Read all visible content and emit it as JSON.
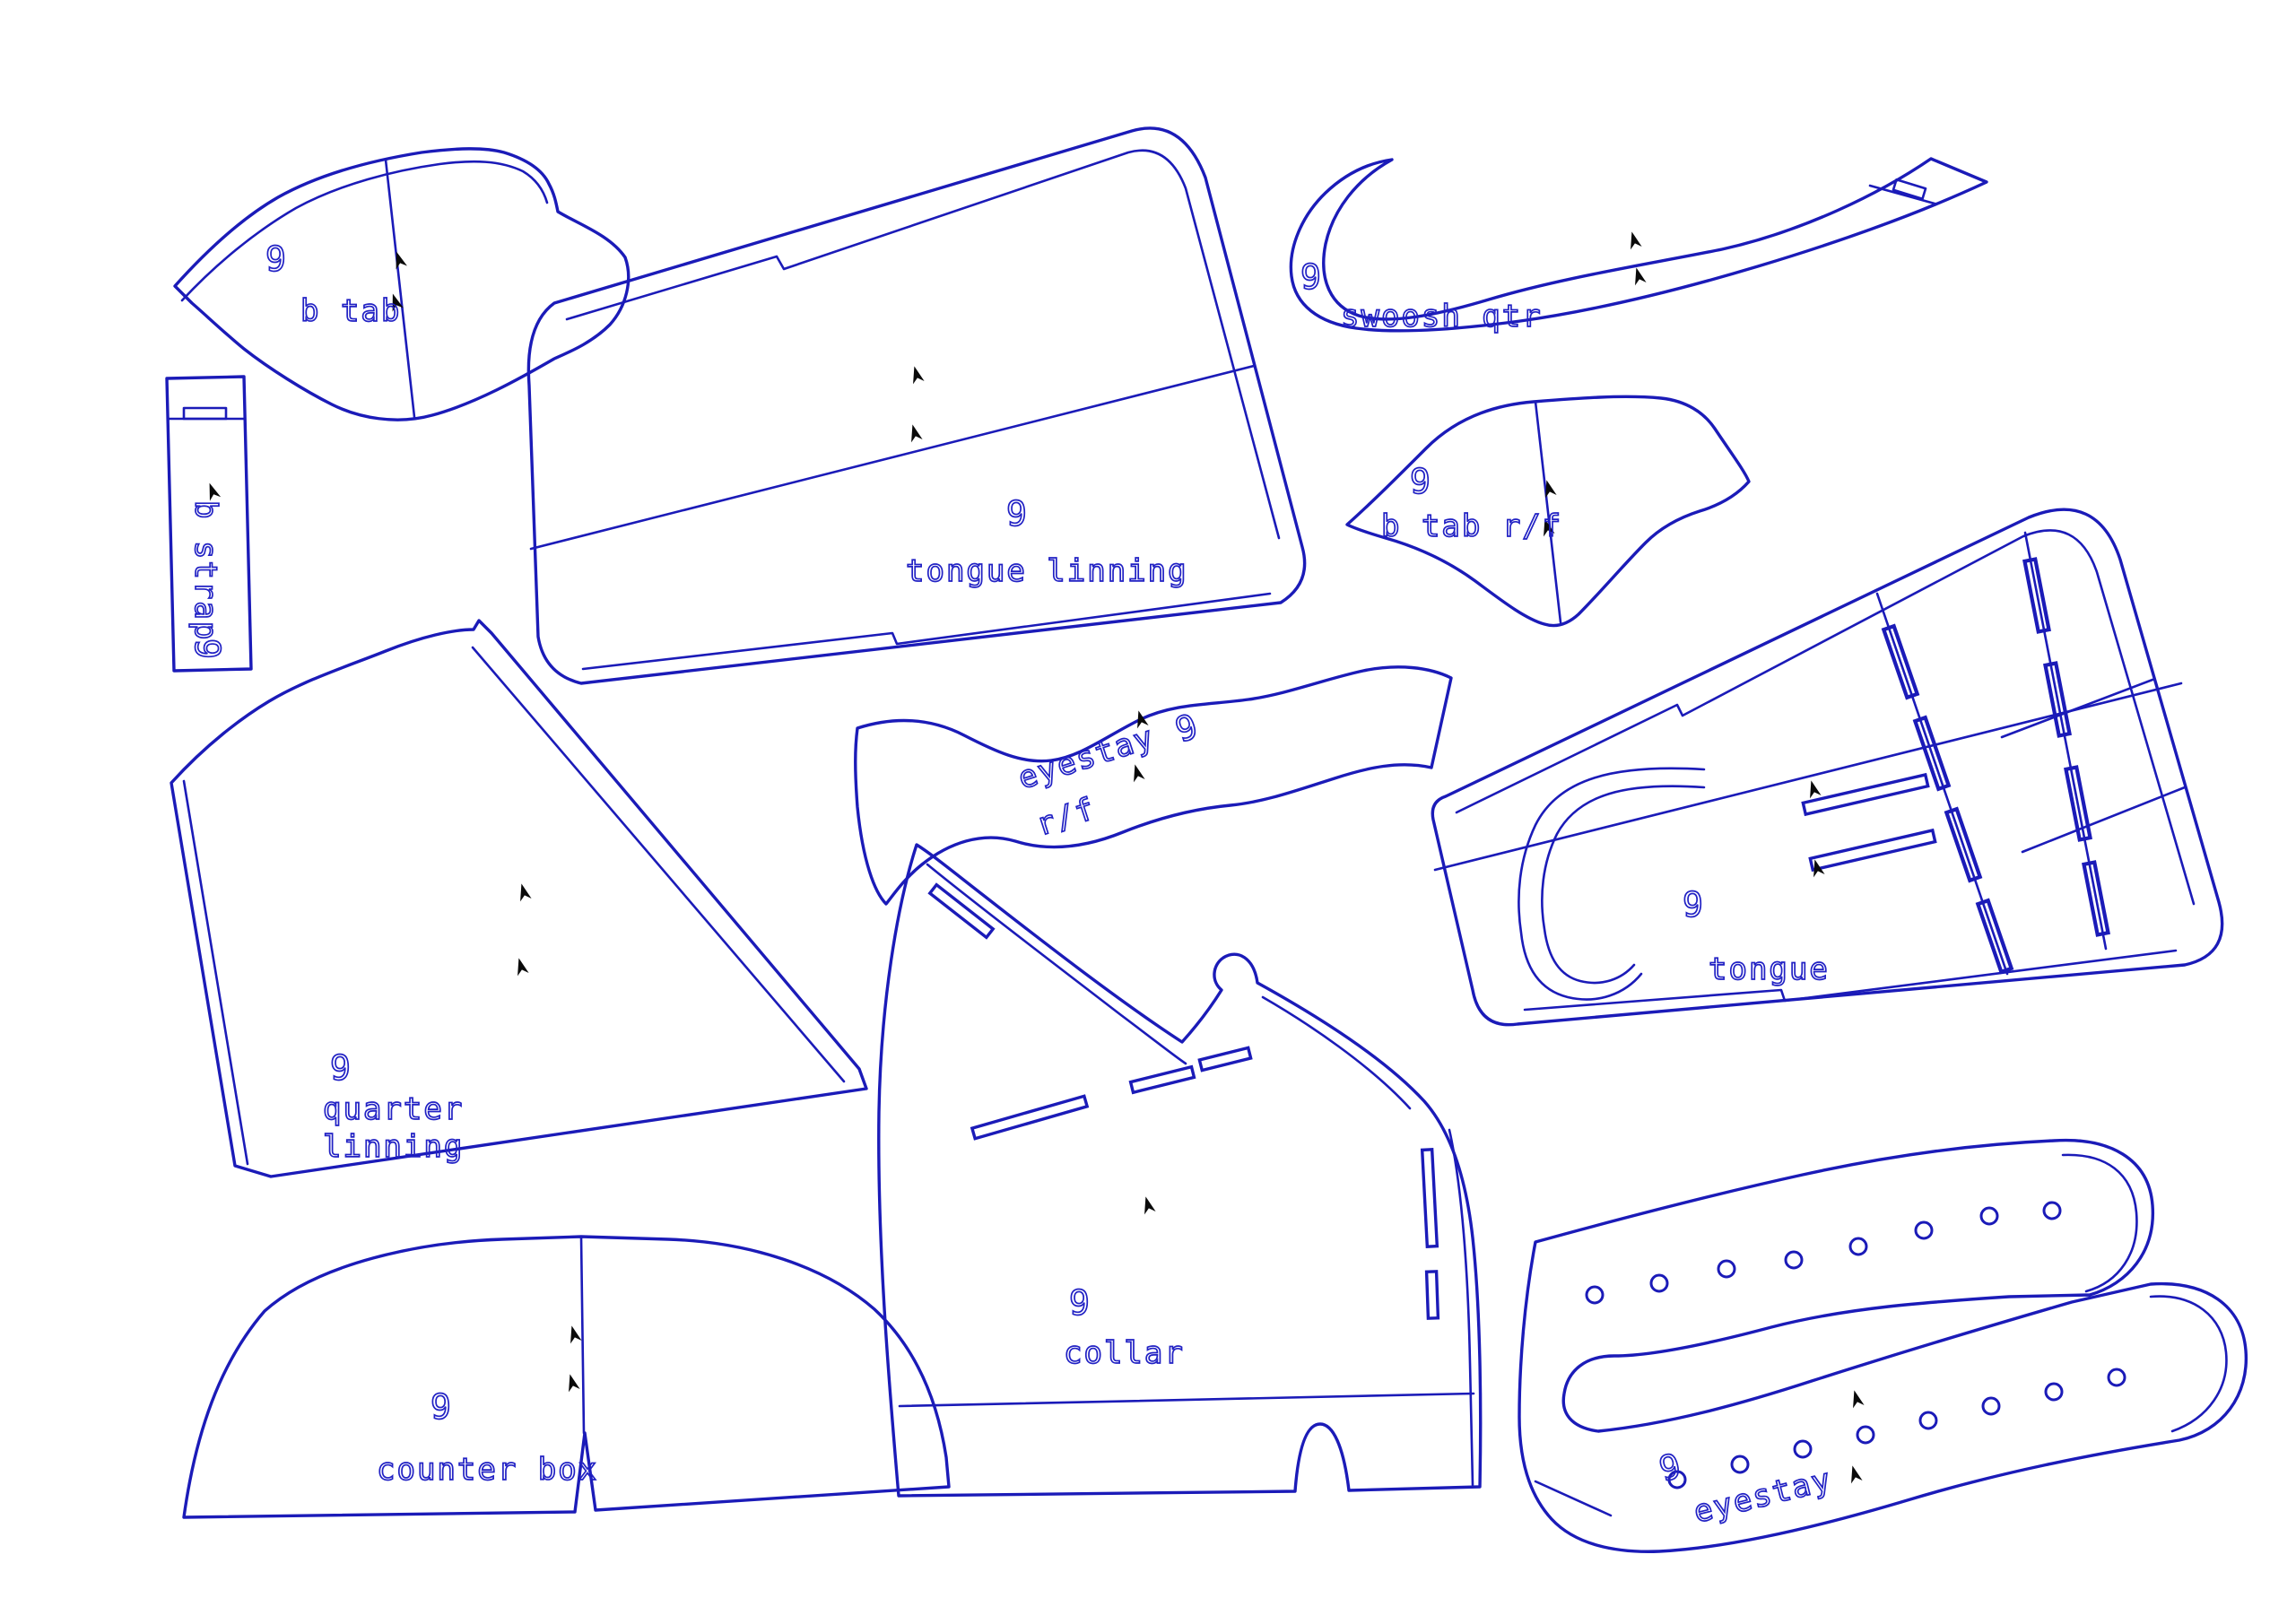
{
  "drawing": {
    "type": "shoe-pattern-cad-layout",
    "background_color": "#ffffff",
    "line_color": "#1b1bb8",
    "label_color": "#2121c4",
    "grain_marker_color": "#0a0a0a",
    "pieces": {
      "b_tab": {
        "size": "9",
        "label": "b tab"
      },
      "b_strap": {
        "size": "9",
        "label": "b strap"
      },
      "tongue_linning": {
        "size": "9",
        "label": "tongue linning"
      },
      "swoosh_qtr": {
        "size": "9",
        "label": "swoosh qtr"
      },
      "b_tab_rf": {
        "size": "9",
        "label": "b tab r/f"
      },
      "eyestay_rf": {
        "size": "9",
        "label_line1": "eyestay",
        "label_line2": "r/f"
      },
      "tongue": {
        "size": "9",
        "label": "tongue"
      },
      "quarter_linning": {
        "size": "9",
        "label_line1": "quarter",
        "label_line2": "linning"
      },
      "counter_box": {
        "size": "9",
        "label": "counter box"
      },
      "collar": {
        "size": "9",
        "label": "collar"
      },
      "eyestay": {
        "size": "9",
        "label": "eyestay",
        "eyelet_count_upper": 8,
        "eyelet_count_lower": 8
      }
    }
  }
}
